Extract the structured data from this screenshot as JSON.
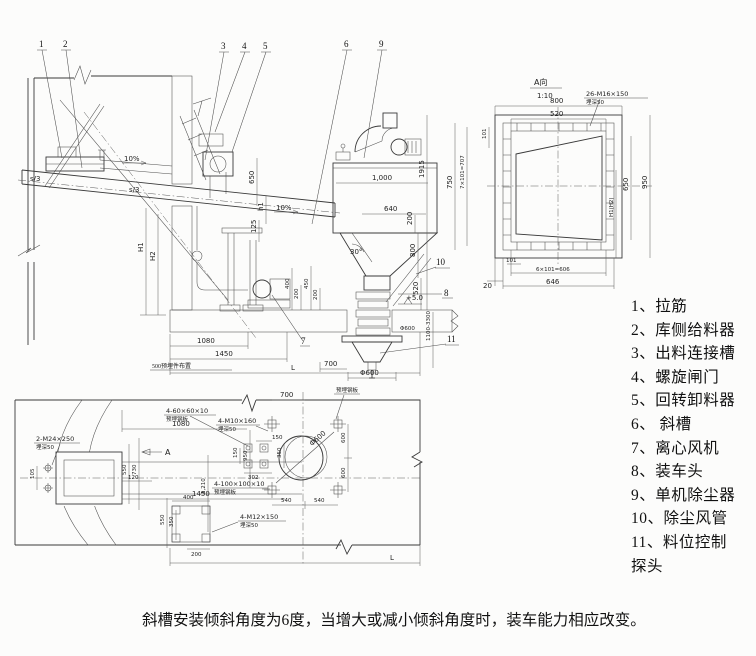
{
  "meta": {
    "caption": "斜槽安装倾斜角度为6度，当增大或减小倾斜角度时，装车能力相应改变。"
  },
  "legend": {
    "items": [
      "1、拉筋",
      "2、库侧给料器",
      "3、出料连接槽",
      "4、螺旋闸门",
      "5、回转卸料器",
      "6、 斜槽",
      "7、离心风机",
      "8、装车头",
      "9、单机除尘器",
      "10、除尘风管",
      "11、料位控制",
      "探头"
    ]
  },
  "callouts": {
    "n1": "1",
    "n2": "2",
    "n3": "3",
    "n4": "4",
    "n5": "5",
    "n6": "6",
    "n7": "7",
    "n8": "8",
    "n9": "9",
    "n10": "10",
    "n11": "11"
  },
  "elev": {
    "s3a": "s/3",
    "s3b": "s/3",
    "slope1": "10%",
    "slope2": "10%",
    "d650": "650",
    "h1": "h1",
    "d125": "125",
    "w1000": "1,000",
    "w640": "640",
    "v1915": "1915",
    "v200": "200",
    "v800": "800",
    "v520": "520",
    "a30": "30°",
    "lvl": "+5.0",
    "dia600a": "Φ600",
    "range": "1100-3300",
    "d700": "700",
    "dia600b": "Φ600",
    "d1080": "1080",
    "d1450": "1450",
    "L": "L",
    "H1": "H1",
    "H2": "H2",
    "note500": "500预埋件布置",
    "s400": "400",
    "s200a": "200",
    "s450": "450",
    "s200b": "200"
  },
  "detail": {
    "title": "A向",
    "scale": "1:10",
    "bolts": "26-M16×150",
    "bolts_note": "埋深50",
    "d800": "800",
    "d520": "520",
    "d101t": "101",
    "v750": "750",
    "v707": "7×101=707",
    "v950": "950",
    "v650": "650",
    "h1h2": "H1(H2)",
    "d20": "20",
    "d101b": "101",
    "d606": "6×101=606",
    "d646": "646"
  },
  "plan": {
    "m24": "2-M24×250",
    "m24_note": "埋深50",
    "g60": "4-60×60×10",
    "g60_note": "预埋钢板",
    "m10": "4-M10×160",
    "m10_note": "埋深50",
    "g100": "4-100×100×10",
    "g100_note": "预埋钢板",
    "m12": "4-M12×150",
    "m12_note": "埋深50",
    "plate": "预埋钢板",
    "d700": "700",
    "d1080": "1080",
    "d1450": "1450",
    "d150a": "150",
    "d302": "302",
    "d150b": "150",
    "d350a": "350",
    "v950": "950",
    "d540a": "540",
    "d540b": "540",
    "d600a": "600",
    "d600b": "600",
    "dia600": "Φ600",
    "v1210": "1,210",
    "d400": "400",
    "d550b": "550",
    "d350b": "350",
    "d200": "200",
    "d550a": "550",
    "d730": "730",
    "d120": "120",
    "d105": "105",
    "L": "L",
    "A": "A"
  }
}
